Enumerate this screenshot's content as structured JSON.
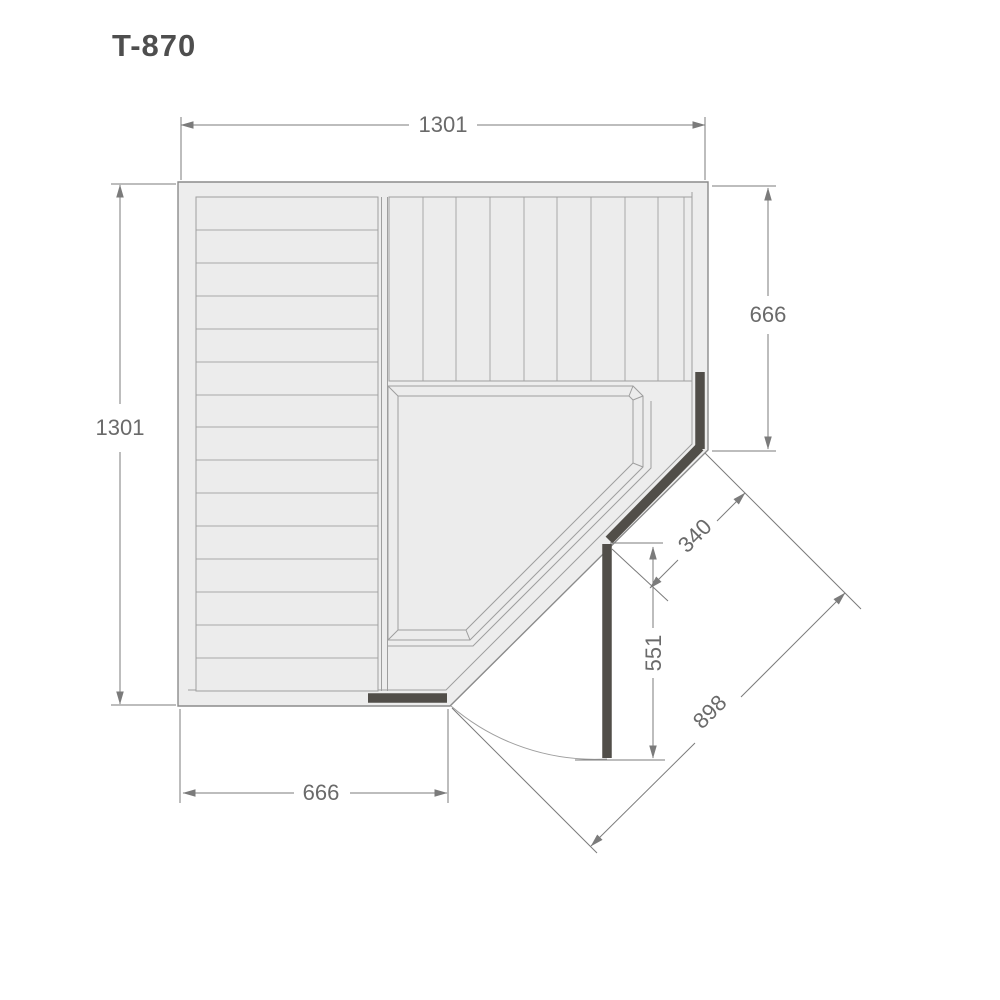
{
  "title": "T-870",
  "plan": {
    "dims": {
      "top_width": "1301",
      "left_height": "1301",
      "right_height": "666",
      "bottom_width": "666",
      "door_glass_width": "340",
      "door_open_depth": "551",
      "diagonal_span": "898"
    },
    "colors": {
      "background": "#ffffff",
      "floor": "#ededed",
      "plank": "#ececec",
      "plank_line": "#a8a8a8",
      "wall_outline": "#8b8b8b",
      "inner_line": "#9e9e9e",
      "glass_dark": "#514e49",
      "dimension_line": "#7b7b7b",
      "dimension_text": "#6a6a6a",
      "title_text": "#4e4e4e"
    }
  }
}
